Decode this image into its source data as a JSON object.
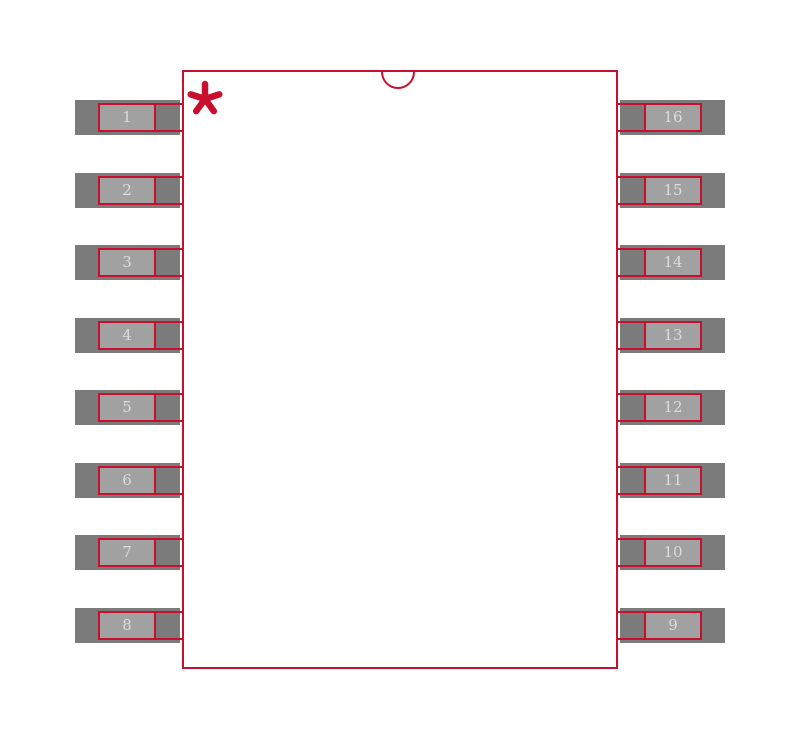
{
  "colors": {
    "outline_red": "#c8102e",
    "pad_dark": "#7b7b7b",
    "pad_light": "#a1a1a1",
    "label_text": "#dcdcdc",
    "background": "#ffffff"
  },
  "footprint": {
    "type": "16-pad dual-row surface-mount land pattern",
    "pin1_marker": {
      "icon": "asterisk-icon",
      "glyph": "*",
      "color": "#c8102e"
    },
    "orientation_notch": {
      "icon": "half-circle-notch-icon",
      "position": "top-center"
    }
  },
  "pads": {
    "left": [
      {
        "label": "1"
      },
      {
        "label": "2"
      },
      {
        "label": "3"
      },
      {
        "label": "4"
      },
      {
        "label": "5"
      },
      {
        "label": "6"
      },
      {
        "label": "7"
      },
      {
        "label": "8"
      }
    ],
    "right": [
      {
        "label": "16"
      },
      {
        "label": "15"
      },
      {
        "label": "14"
      },
      {
        "label": "13"
      },
      {
        "label": "12"
      },
      {
        "label": "11"
      },
      {
        "label": "10"
      },
      {
        "label": "9"
      }
    ]
  }
}
